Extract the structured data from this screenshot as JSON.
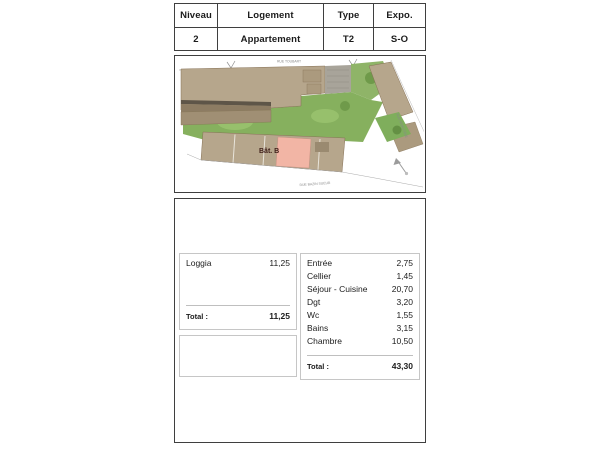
{
  "unit_header": {
    "cells": [
      {
        "label": "Niveau",
        "value": "2"
      },
      {
        "label": "Logement",
        "value": "Appartement"
      },
      {
        "label": "Type",
        "value": "T2"
      },
      {
        "label": "Expo.",
        "value": "S-O"
      }
    ]
  },
  "site_plan": {
    "building_label": "Bât. B",
    "street_top": "RUE TOUBART",
    "street_bottom": "RUE BAZIN SUEUR",
    "street_right": "RUE MONTOISE",
    "compass_icon": "north-arrow",
    "colors": {
      "roof_tan": "#b6a68c",
      "roof_dark": "#9a8a70",
      "lawn_green": "#86b05e",
      "highlight_pink": "#f2b5a5",
      "stone_gray": "#a8a49a"
    }
  },
  "areas": {
    "annex_table": {
      "rows": [
        {
          "label": "Loggia",
          "value": "11,25"
        }
      ],
      "total_label": "Total :",
      "total_value": "11,25"
    },
    "main_table": {
      "rows": [
        {
          "label": "Entrée",
          "value": "2,75"
        },
        {
          "label": "Cellier",
          "value": "1,45"
        },
        {
          "label": "Séjour - Cuisine",
          "value": "20,70"
        },
        {
          "label": "Dgt",
          "value": "3,20"
        },
        {
          "label": "Wc",
          "value": "1,55"
        },
        {
          "label": "Bains",
          "value": "3,15"
        },
        {
          "label": "Chambre",
          "value": "10,50"
        }
      ],
      "total_label": "Total :",
      "total_value": "43,30"
    }
  }
}
